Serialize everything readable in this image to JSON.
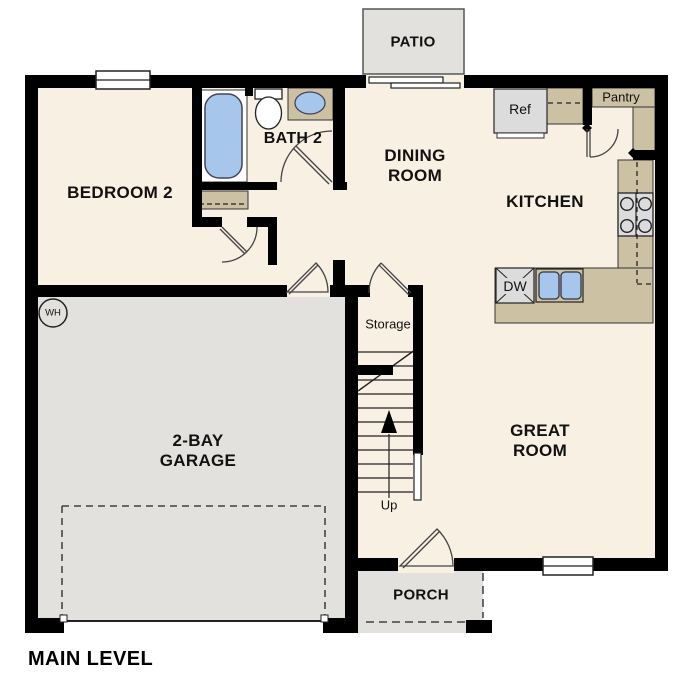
{
  "title": "MAIN LEVEL",
  "rooms": {
    "patio": "PATIO",
    "bedroom2": "BEDROOM 2",
    "bath2": "BATH 2",
    "dining": "DINING ROOM",
    "kitchen": "KITCHEN",
    "great_room": "GREAT ROOM",
    "garage": "2-BAY GARAGE",
    "storage": "Storage",
    "porch": "PORCH"
  },
  "fixtures": {
    "refrigerator": "Ref",
    "pantry": "Pantry",
    "dishwasher": "DW",
    "water_heater": "WH",
    "stairs_direction": "Up"
  },
  "colors": {
    "wall": "#000000",
    "floor": "#f7f0e3",
    "exterior_concrete": "#e2e1de",
    "counter": "#cdc1a4",
    "fixture_blue": "#a6c7eb",
    "appliance": "#dcdcdc"
  }
}
